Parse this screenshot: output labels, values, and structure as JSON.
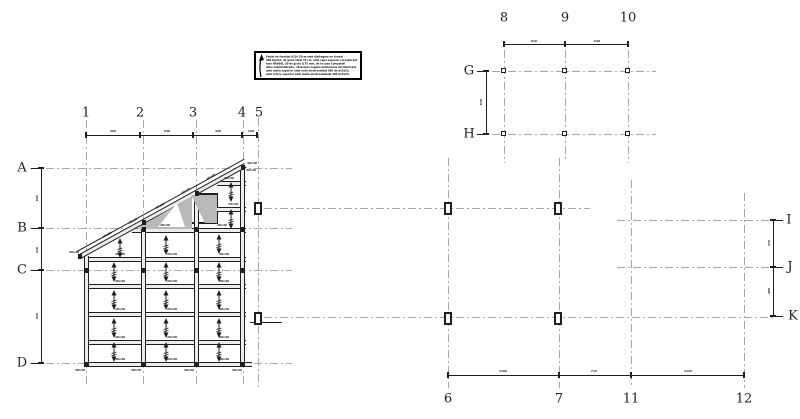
{
  "title": "Structural framing and foundation grid plan",
  "colors": {
    "dark": "#1f1f1f",
    "grid": "#a4a9ac",
    "beam_fill": "#ececec",
    "shade": "#b9b9b9",
    "bg": "#ffffff"
  },
  "note_box": {
    "lines": [
      "Forjat de formigó h20+25cm amb diafragma en chaval",
      "300 Kg/m2, de gruix total 70 cm, amb capa superior col·laborant",
      "fase HA60/B, 50 de gruix 0,75 mm, de la casa Compatell",
      "altre subministrada, i fixacions segons indicacions del fabricant",
      "amb malla superior amb rodó electrosoldat 500 de ø15x15,",
      "amb reforç superior amb malla electrosoldada 500 ø15x15."
    ]
  },
  "axis_labels": [
    [
      "1",
      86,
      113
    ],
    [
      "2",
      140,
      113
    ],
    [
      "3",
      193,
      113
    ],
    [
      "4",
      242,
      113
    ],
    [
      "5",
      259,
      113
    ],
    [
      "8",
      504,
      18
    ],
    [
      "9",
      565,
      18
    ],
    [
      "10",
      628,
      18
    ],
    [
      "6",
      448,
      399
    ],
    [
      "7",
      559,
      399
    ],
    [
      "11",
      631,
      399
    ],
    [
      "12",
      744,
      399
    ],
    [
      "A",
      22,
      168
    ],
    [
      "B",
      22,
      228
    ],
    [
      "C",
      22,
      270
    ],
    [
      "D",
      22,
      363
    ],
    [
      "G",
      469,
      71
    ],
    [
      "H",
      469,
      134
    ],
    [
      "I",
      789,
      220
    ],
    [
      "J",
      790,
      267
    ],
    [
      "K",
      793,
      316
    ]
  ],
  "tiny_labels": [
    [
      "460",
      113,
      131,
      0
    ],
    [
      "530",
      167,
      131,
      0
    ],
    [
      "490",
      218,
      131,
      0
    ],
    [
      "160",
      251,
      131,
      0
    ],
    [
      "616",
      534,
      41,
      0
    ],
    [
      "628",
      597,
      41,
      0
    ],
    [
      "1100",
      503,
      371,
      0
    ],
    [
      "715",
      594,
      371,
      0
    ],
    [
      "1125",
      688,
      371,
      0
    ],
    [
      "600",
      37,
      198,
      -90
    ],
    [
      "420",
      37,
      250,
      -90
    ],
    [
      "920",
      37,
      316,
      -90
    ],
    [
      "625",
      481,
      102,
      -90
    ],
    [
      "470",
      769,
      243,
      -90
    ],
    [
      "485",
      769,
      291,
      -90
    ],
    [
      "40x30",
      165,
      225,
      0
    ],
    [
      "40x30",
      222,
      225,
      0
    ],
    [
      "40x30",
      120,
      254,
      0
    ],
    [
      "25x30",
      172,
      254,
      0
    ],
    [
      "40x30",
      224,
      254,
      0
    ],
    [
      "40x30",
      120,
      281,
      0
    ],
    [
      "25x30",
      172,
      281,
      0
    ],
    [
      "40x30",
      224,
      281,
      0
    ],
    [
      "40x30",
      120,
      309,
      0
    ],
    [
      "25x30",
      172,
      309,
      0
    ],
    [
      "40x30",
      224,
      309,
      0
    ],
    [
      "40x30",
      120,
      337,
      0
    ],
    [
      "25x30",
      172,
      337,
      0
    ],
    [
      "40x30",
      224,
      337,
      0
    ],
    [
      "40x30",
      120,
      359,
      0
    ],
    [
      "25x30",
      172,
      359,
      0
    ],
    [
      "40x30",
      224,
      359,
      0
    ],
    [
      "25x30",
      229,
      178,
      0
    ],
    [
      "25x30",
      233,
      204,
      0
    ],
    [
      "30x30",
      251,
      170,
      0
    ],
    [
      "40x30",
      107,
      235,
      -29
    ],
    [
      "40x30",
      133,
      221,
      -29
    ],
    [
      "40x30",
      160,
      206,
      -29
    ],
    [
      "40x30",
      186,
      191,
      -29
    ],
    [
      "40x30",
      211,
      177,
      -29
    ],
    [
      "30x30",
      80,
      370,
      0
    ],
    [
      "30x30",
      136,
      370,
      0
    ],
    [
      "30x30",
      189,
      370,
      0
    ],
    [
      "30x30",
      237,
      370,
      0
    ],
    [
      "30x30",
      74,
      252,
      0
    ],
    [
      "30x30",
      252,
      163,
      0
    ]
  ],
  "lines": {
    "dashdot_h": [
      [
        30,
        168,
        262
      ],
      [
        30,
        228,
        262
      ],
      [
        30,
        270,
        262
      ],
      [
        30,
        363,
        262
      ],
      [
        492,
        71,
        164
      ],
      [
        492,
        134,
        164
      ],
      [
        264,
        208,
        326
      ],
      [
        617,
        220,
        158
      ],
      [
        617,
        267,
        158
      ],
      [
        264,
        317,
        512
      ]
    ],
    "dashdot_v": [
      [
        86,
        120,
        266
      ],
      [
        143,
        120,
        266
      ],
      [
        196,
        120,
        266
      ],
      [
        243,
        120,
        266
      ],
      [
        258,
        118,
        272
      ],
      [
        448,
        158,
        230
      ],
      [
        559,
        158,
        230
      ],
      [
        504,
        50,
        113
      ],
      [
        565,
        50,
        110
      ],
      [
        628,
        50,
        113
      ],
      [
        631,
        180,
        208
      ],
      [
        744,
        193,
        195
      ]
    ],
    "solid_h": [
      [
        86,
        135,
        172,
        0
      ],
      [
        504,
        44,
        124,
        0
      ],
      [
        448,
        375,
        296,
        0
      ],
      [
        31,
        168,
        10,
        0
      ],
      [
        31,
        228,
        10,
        0
      ],
      [
        31,
        270,
        10,
        0
      ],
      [
        31,
        363,
        10,
        0
      ],
      [
        477,
        71,
        9,
        0
      ],
      [
        477,
        134,
        9,
        0
      ],
      [
        774,
        220,
        9,
        0
      ],
      [
        774,
        267,
        9,
        0
      ],
      [
        774,
        316,
        9,
        0
      ],
      [
        250,
        322,
        32,
        0
      ]
    ],
    "solid_v": [
      [
        41,
        168,
        195
      ],
      [
        486,
        71,
        63
      ],
      [
        773,
        220,
        96
      ]
    ]
  },
  "beams": {
    "h": [
      [
        217,
        181,
        29
      ],
      [
        217,
        207,
        29
      ],
      [
        132,
        228,
        114
      ],
      [
        86,
        257,
        160
      ],
      [
        86,
        284,
        160
      ],
      [
        86,
        312,
        160
      ],
      [
        86,
        340,
        160
      ],
      [
        84,
        362,
        168
      ]
    ],
    "v": [
      [
        84,
        256,
        111
      ],
      [
        141,
        222,
        145
      ],
      [
        194,
        193,
        174
      ],
      [
        240,
        167,
        200
      ]
    ],
    "diag": [
      [
        80,
        254,
        189,
        -28.9,
        0
      ],
      [
        77,
        251,
        191,
        -28.9,
        1
      ]
    ]
  },
  "ticks": {
    "v": [
      [
        86,
        135
      ],
      [
        140,
        135
      ],
      [
        193,
        135
      ],
      [
        242,
        135
      ],
      [
        257,
        135
      ],
      [
        504,
        44
      ],
      [
        565,
        44
      ],
      [
        628,
        44
      ],
      [
        448,
        375
      ],
      [
        559,
        375
      ],
      [
        631,
        375
      ],
      [
        744,
        375
      ]
    ],
    "h": [
      [
        41,
        168
      ],
      [
        41,
        228
      ],
      [
        41,
        270
      ],
      [
        41,
        363
      ],
      [
        486,
        71
      ],
      [
        486,
        134
      ],
      [
        773,
        220
      ],
      [
        773,
        267
      ],
      [
        773,
        316
      ]
    ]
  },
  "columns": {
    "filled": [
      [
        144,
        229
      ],
      [
        197,
        229
      ],
      [
        243,
        229
      ],
      [
        86,
        270
      ],
      [
        144,
        270
      ],
      [
        197,
        270
      ],
      [
        243,
        270
      ],
      [
        86,
        364
      ],
      [
        144,
        364
      ],
      [
        197,
        364
      ],
      [
        243,
        364
      ],
      [
        80,
        256
      ],
      [
        243,
        167
      ],
      [
        197,
        193
      ],
      [
        144,
        222
      ]
    ],
    "square": [
      [
        504,
        71
      ],
      [
        565,
        71
      ],
      [
        628,
        71
      ],
      [
        504,
        134
      ],
      [
        565,
        134
      ],
      [
        628,
        134
      ]
    ],
    "rect": [
      [
        258,
        208
      ],
      [
        448,
        208
      ],
      [
        558,
        208
      ],
      [
        258,
        318
      ],
      [
        448,
        318
      ],
      [
        558,
        318
      ]
    ]
  },
  "arrows": [
    [
      120,
      248
    ],
    [
      166,
      245
    ],
    [
      219,
      244
    ],
    [
      114,
      272
    ],
    [
      166,
      272
    ],
    [
      219,
      272
    ],
    [
      114,
      300
    ],
    [
      166,
      300
    ],
    [
      219,
      300
    ],
    [
      114,
      328
    ],
    [
      166,
      328
    ],
    [
      219,
      328
    ],
    [
      114,
      352
    ],
    [
      166,
      352
    ],
    [
      219,
      352
    ],
    [
      231,
      192
    ],
    [
      231,
      219
    ]
  ],
  "shading": [
    {
      "points": "136,229 192,196 192,229",
      "fill": "#b9b9b9"
    },
    {
      "points": "158,227 177,203 185,227",
      "fill": "#ffffff"
    },
    {
      "points": "191,195 217,195 217,223 205,223",
      "fill": "#b9b9b9"
    }
  ],
  "opening": {
    "x": 189,
    "y": 193,
    "w": 29,
    "h": 31
  }
}
